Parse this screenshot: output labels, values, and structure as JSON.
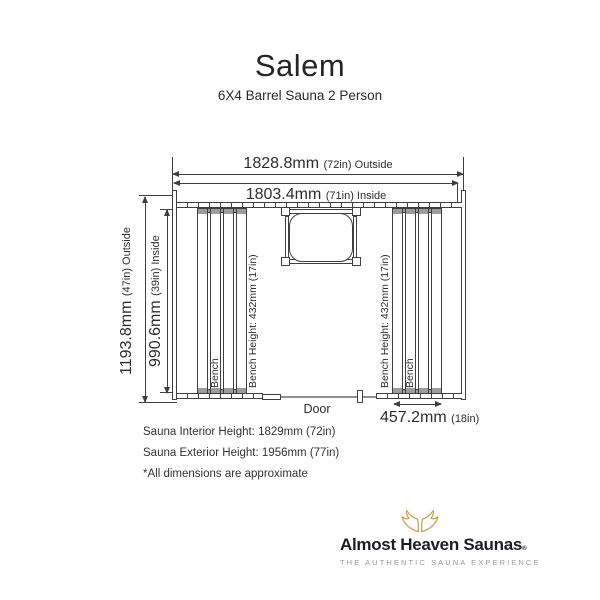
{
  "title": "Salem",
  "subtitle": "6X4 Barrel Sauna 2 Person",
  "dimensions": {
    "outside_width": {
      "value": "1828.8mm",
      "note": "(72in) Outside"
    },
    "inside_width": {
      "value": "1803.4mm",
      "note": "(71in) Inside"
    },
    "outside_depth": {
      "value": "1193.8mm",
      "note": "(47in) Outside"
    },
    "inside_depth": {
      "value": "990.6mm",
      "note": "(39in) Inside"
    },
    "bench_depth": {
      "value": "457.2mm",
      "note": "(18in)"
    }
  },
  "labels": {
    "bench": "Bench",
    "bench_height": "Bench Height: 432mm (17in)",
    "door": "Door"
  },
  "notes": [
    "Sauna Interior Height: 1829mm (72in)",
    "Sauna Exterior Height: 1956mm (77in)",
    "*All dimensions are approximate"
  ],
  "logo": {
    "name": "Almost Heaven Saunas",
    "mark": "®",
    "tagline": "THE AUTHENTIC SAUNA EXPERIENCE"
  },
  "colors": {
    "line": "#3f3f3f",
    "text": "#2d2d2d",
    "muted_fill": "#9c9c9c",
    "door_line": "#8f8f8f",
    "logo_text": "#1d1d26",
    "logo_wing": "#c5a14e",
    "logo_tagline": "#9a9a9a"
  }
}
